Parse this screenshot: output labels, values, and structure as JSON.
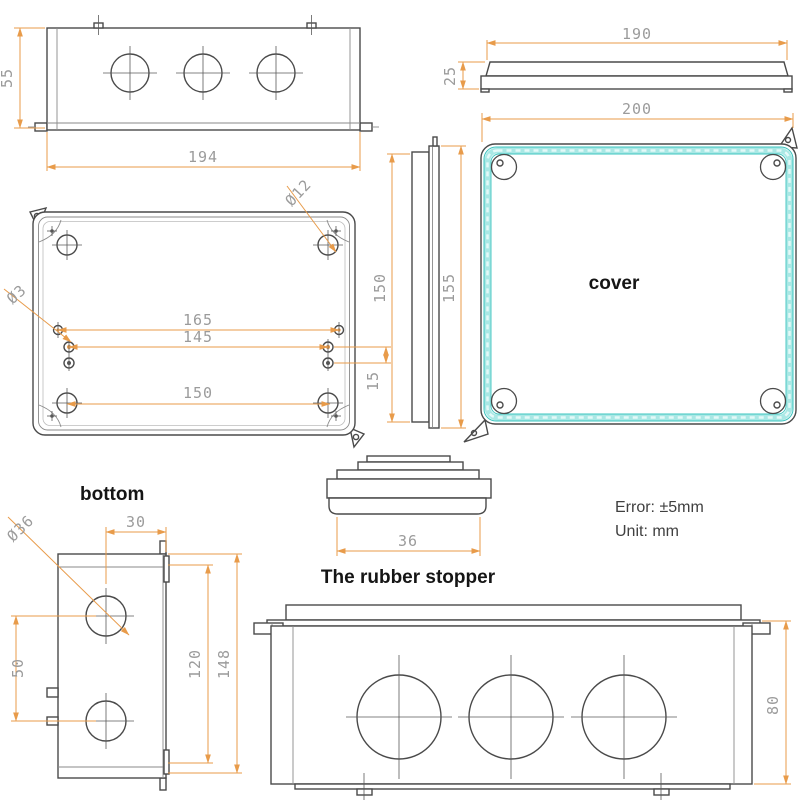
{
  "title": "Waterproof junction box dimension drawing",
  "views": {
    "front": {
      "height": "55",
      "width": "194"
    },
    "cover_profile": {
      "width": "190",
      "height": "25"
    },
    "base_bottom": {
      "corner_hole": "Ø12",
      "small_hole": "Ø3",
      "span_top": "165",
      "span_mid": "145",
      "span_bottom": "150",
      "offset": "15"
    },
    "cover_side": {
      "inner_height": "150",
      "outer_height": "155"
    },
    "cover_top": {
      "label": "cover",
      "width": "200"
    },
    "end_view": {
      "label": "bottom",
      "hole": "Ø36",
      "edge_offset": "30",
      "hole_pitch": "50",
      "inner_height": "120",
      "outer_height": "148"
    },
    "stopper": {
      "label": "The rubber stopper",
      "width": "36"
    },
    "assembled": {
      "height": "80"
    }
  },
  "notes": {
    "error": "Error: ±5mm",
    "unit": "Unit: mm"
  },
  "colors": {
    "dimension_line": "#e89b4a",
    "dimension_text": "#9b9b9b",
    "drawing_line": "#4a4a4a",
    "gasket_teal": "#3cc4bf",
    "gasket_teal_light": "#a9e8e5",
    "label_text": "#151515"
  }
}
